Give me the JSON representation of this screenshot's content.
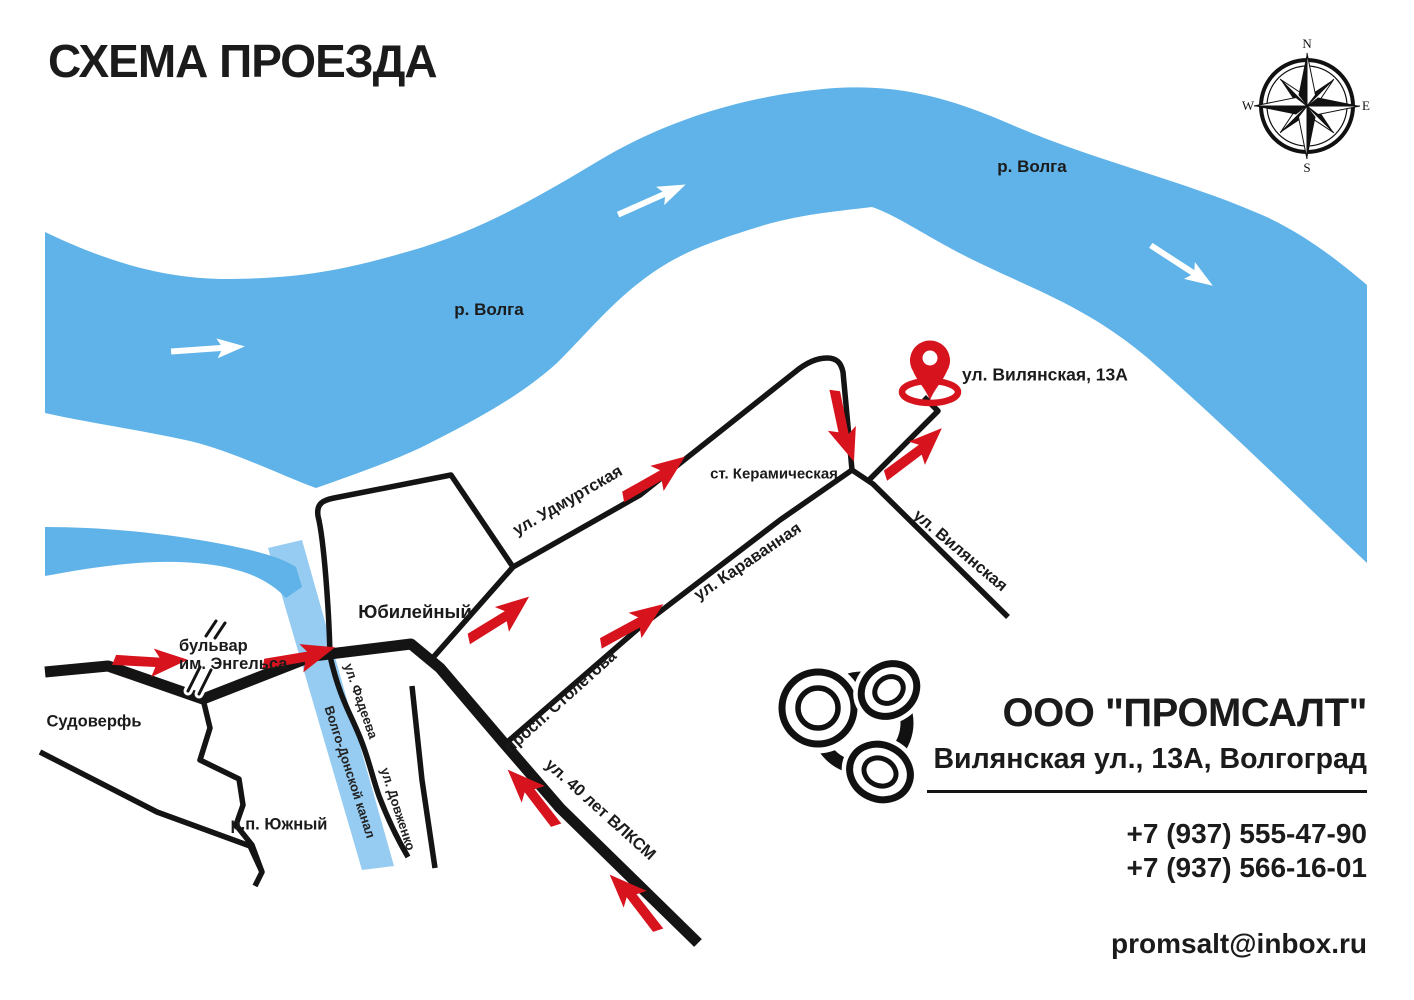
{
  "title": "СХЕМА ПРОЕЗДА",
  "map": {
    "river_label_1": "р. Волга",
    "river_label_2": "р. Волга",
    "canal_label": "Волго-Донской канал",
    "destination_label": "ул. Вилянская, 13А",
    "station_label": "ст. Керамическая",
    "streets": {
      "udmurtskaya": "ул. Удмуртская",
      "karavannaya": "ул. Караванная",
      "stoletova": "просп. Столетова",
      "vlksm": "ул. 40 лет ВЛКСМ",
      "vilyanskaya": "ул. Вилянская",
      "fadeeva": "ул. Фадеева",
      "dovzhenko": "ул. Довженко",
      "engels_line1": "бульвар",
      "engels_line2": "им. Энгельса"
    },
    "places": {
      "yubileyny": "Юбилейный",
      "sudoverf": "Судоверфь",
      "yuzhny": "р.п. Южный"
    },
    "compass": {
      "n": "N",
      "e": "E",
      "s": "S",
      "w": "W"
    }
  },
  "company": {
    "name": "ООО \"ПРОМСАЛТ\"",
    "address": "Вилянская ул., 13А, Волгоград",
    "phones": [
      "+7 (937) 555-47-90",
      "+7 (937) 566-16-01"
    ],
    "email": "promsalt@inbox.ru"
  },
  "colors": {
    "river_blue": "#5FB3E8",
    "canal_blue": "#96CCF1",
    "road_black": "#141414",
    "accent_red": "#D7141E"
  }
}
